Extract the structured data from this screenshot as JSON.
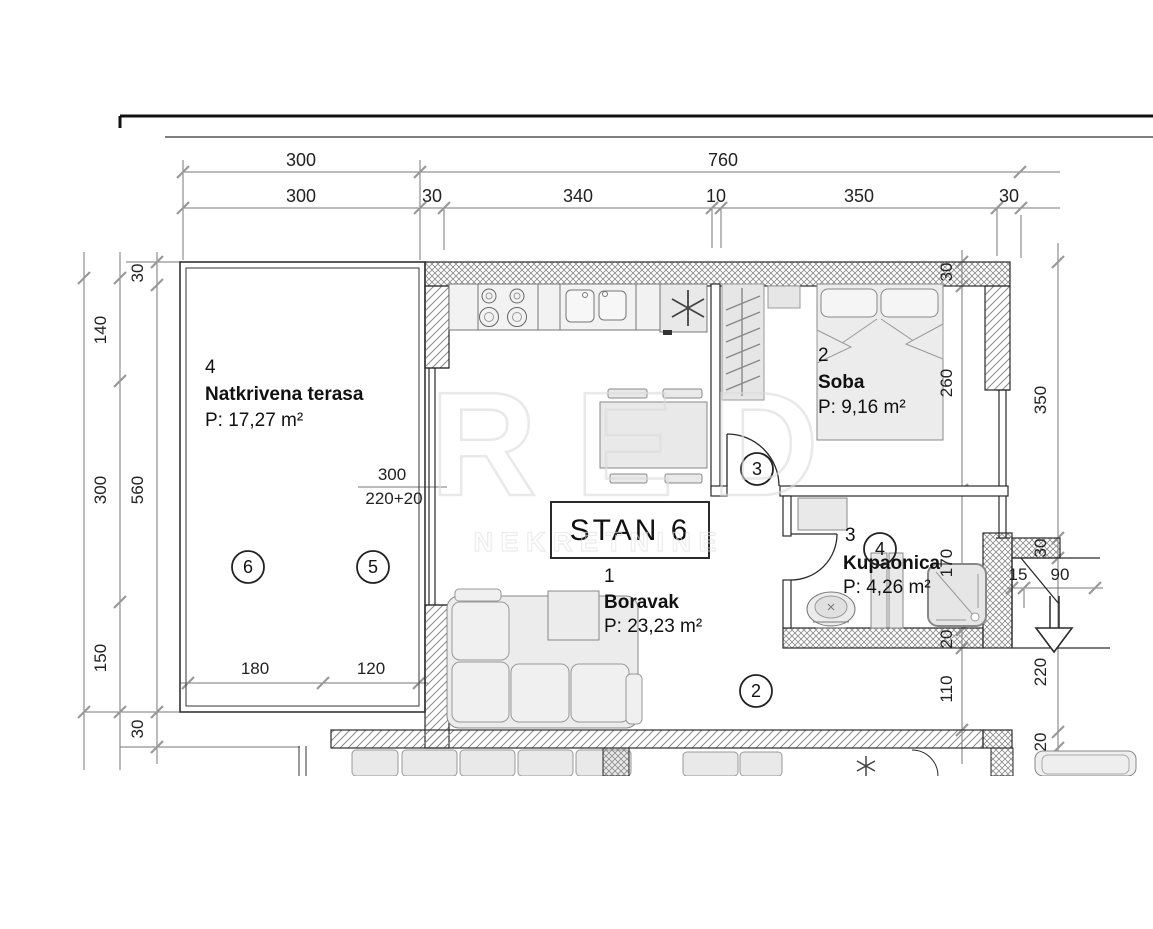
{
  "plan": {
    "unit_label": "STAN 6",
    "rooms": {
      "boravak": {
        "index": "1",
        "name": "Boravak",
        "area": "P: 23,23 m²"
      },
      "soba": {
        "index": "2",
        "name": "Soba",
        "area": "P: 9,16 m²"
      },
      "kupaonica": {
        "index": "3",
        "name": "Kupaonica",
        "area": "P: 4,26 m²"
      },
      "terasa": {
        "index": "4",
        "name": "Natkrivena terasa",
        "area": "P: 17,27 m²"
      }
    },
    "markers": {
      "m2": "2",
      "m3": "3",
      "m4": "4",
      "m5": "5",
      "m6": "6"
    },
    "watermark": {
      "title": "RED",
      "subtitle": "N E K R E T N I N E"
    },
    "dims": {
      "top1_300": "300",
      "top1_760": "760",
      "top2_300": "300",
      "top2_30": "30",
      "top2_340": "340",
      "top2_10": "10",
      "top2_350": "350",
      "top2_30b": "30",
      "left_140": "140",
      "left_300": "300",
      "left_150": "150",
      "left_30a": "30",
      "left_560": "560",
      "left_30b": "30",
      "right_30": "30",
      "right_260": "260",
      "right_170": "170",
      "right_20a": "20",
      "right_110": "110",
      "right_350": "350",
      "right_30b": "30",
      "right_220": "220",
      "right_20b": "20",
      "right_15": "15",
      "right_90": "90",
      "ter_180": "180",
      "ter_120": "120",
      "opening_w": "300",
      "opening_h": "220+20"
    },
    "colors": {
      "line": "#2a2a2a",
      "dim_line": "#777777",
      "tick": "#999999",
      "furniture_fill": "#ececec",
      "watermark": "#dcdcdc"
    }
  }
}
